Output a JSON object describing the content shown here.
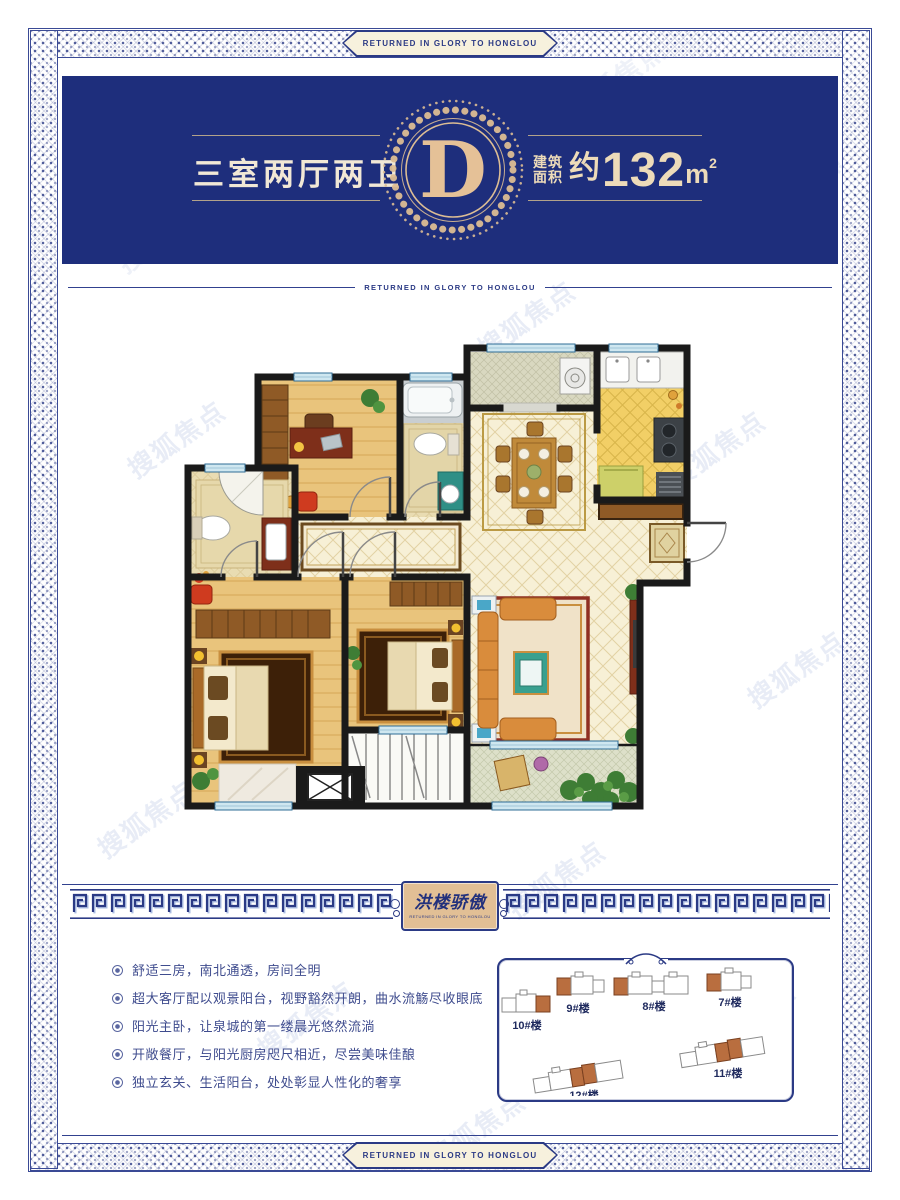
{
  "motto": "RETURNED IN GLORY TO HONGLOU",
  "header": {
    "title": "三室两厅两卫",
    "emblem_letter": "D",
    "area_label_line1": "建筑",
    "area_label_line2": "面积",
    "area_approx": "约",
    "area_value": "132",
    "area_unit": "m",
    "area_sup": "2"
  },
  "seal": {
    "title": "洪楼骄傲",
    "subtitle": "RETURNED IN GLORY TO HONGLOU"
  },
  "features": {
    "items": [
      "舒适三房，南北通透，房间全明",
      "超大客厅配以观景阳台，视野豁然开朗，曲水流觞尽收眼底",
      "阳光主卧，让泉城的第一缕晨光悠然流淌",
      "开敞餐厅，与阳光厨房咫尺相近，尽尝美味佳酿",
      "独立玄关、生活阳台，处处彰显人性化的奢享"
    ]
  },
  "siteplan": {
    "buildings": [
      {
        "label": "10#楼"
      },
      {
        "label": "9#楼"
      },
      {
        "label": "8#楼"
      },
      {
        "label": "7#楼"
      },
      {
        "label": "11#楼"
      },
      {
        "label": "12#楼"
      }
    ]
  },
  "watermark": {
    "text": "搜狐焦点"
  },
  "colors": {
    "navy": "#1e2e7c",
    "border_navy": "#2b3a85",
    "gold": "#dcbd94",
    "cream": "#f1e8d6",
    "seal_bg": "#e2bf95",
    "building_orange": "#b96e3f",
    "feature_text": "#3f4c8e"
  }
}
